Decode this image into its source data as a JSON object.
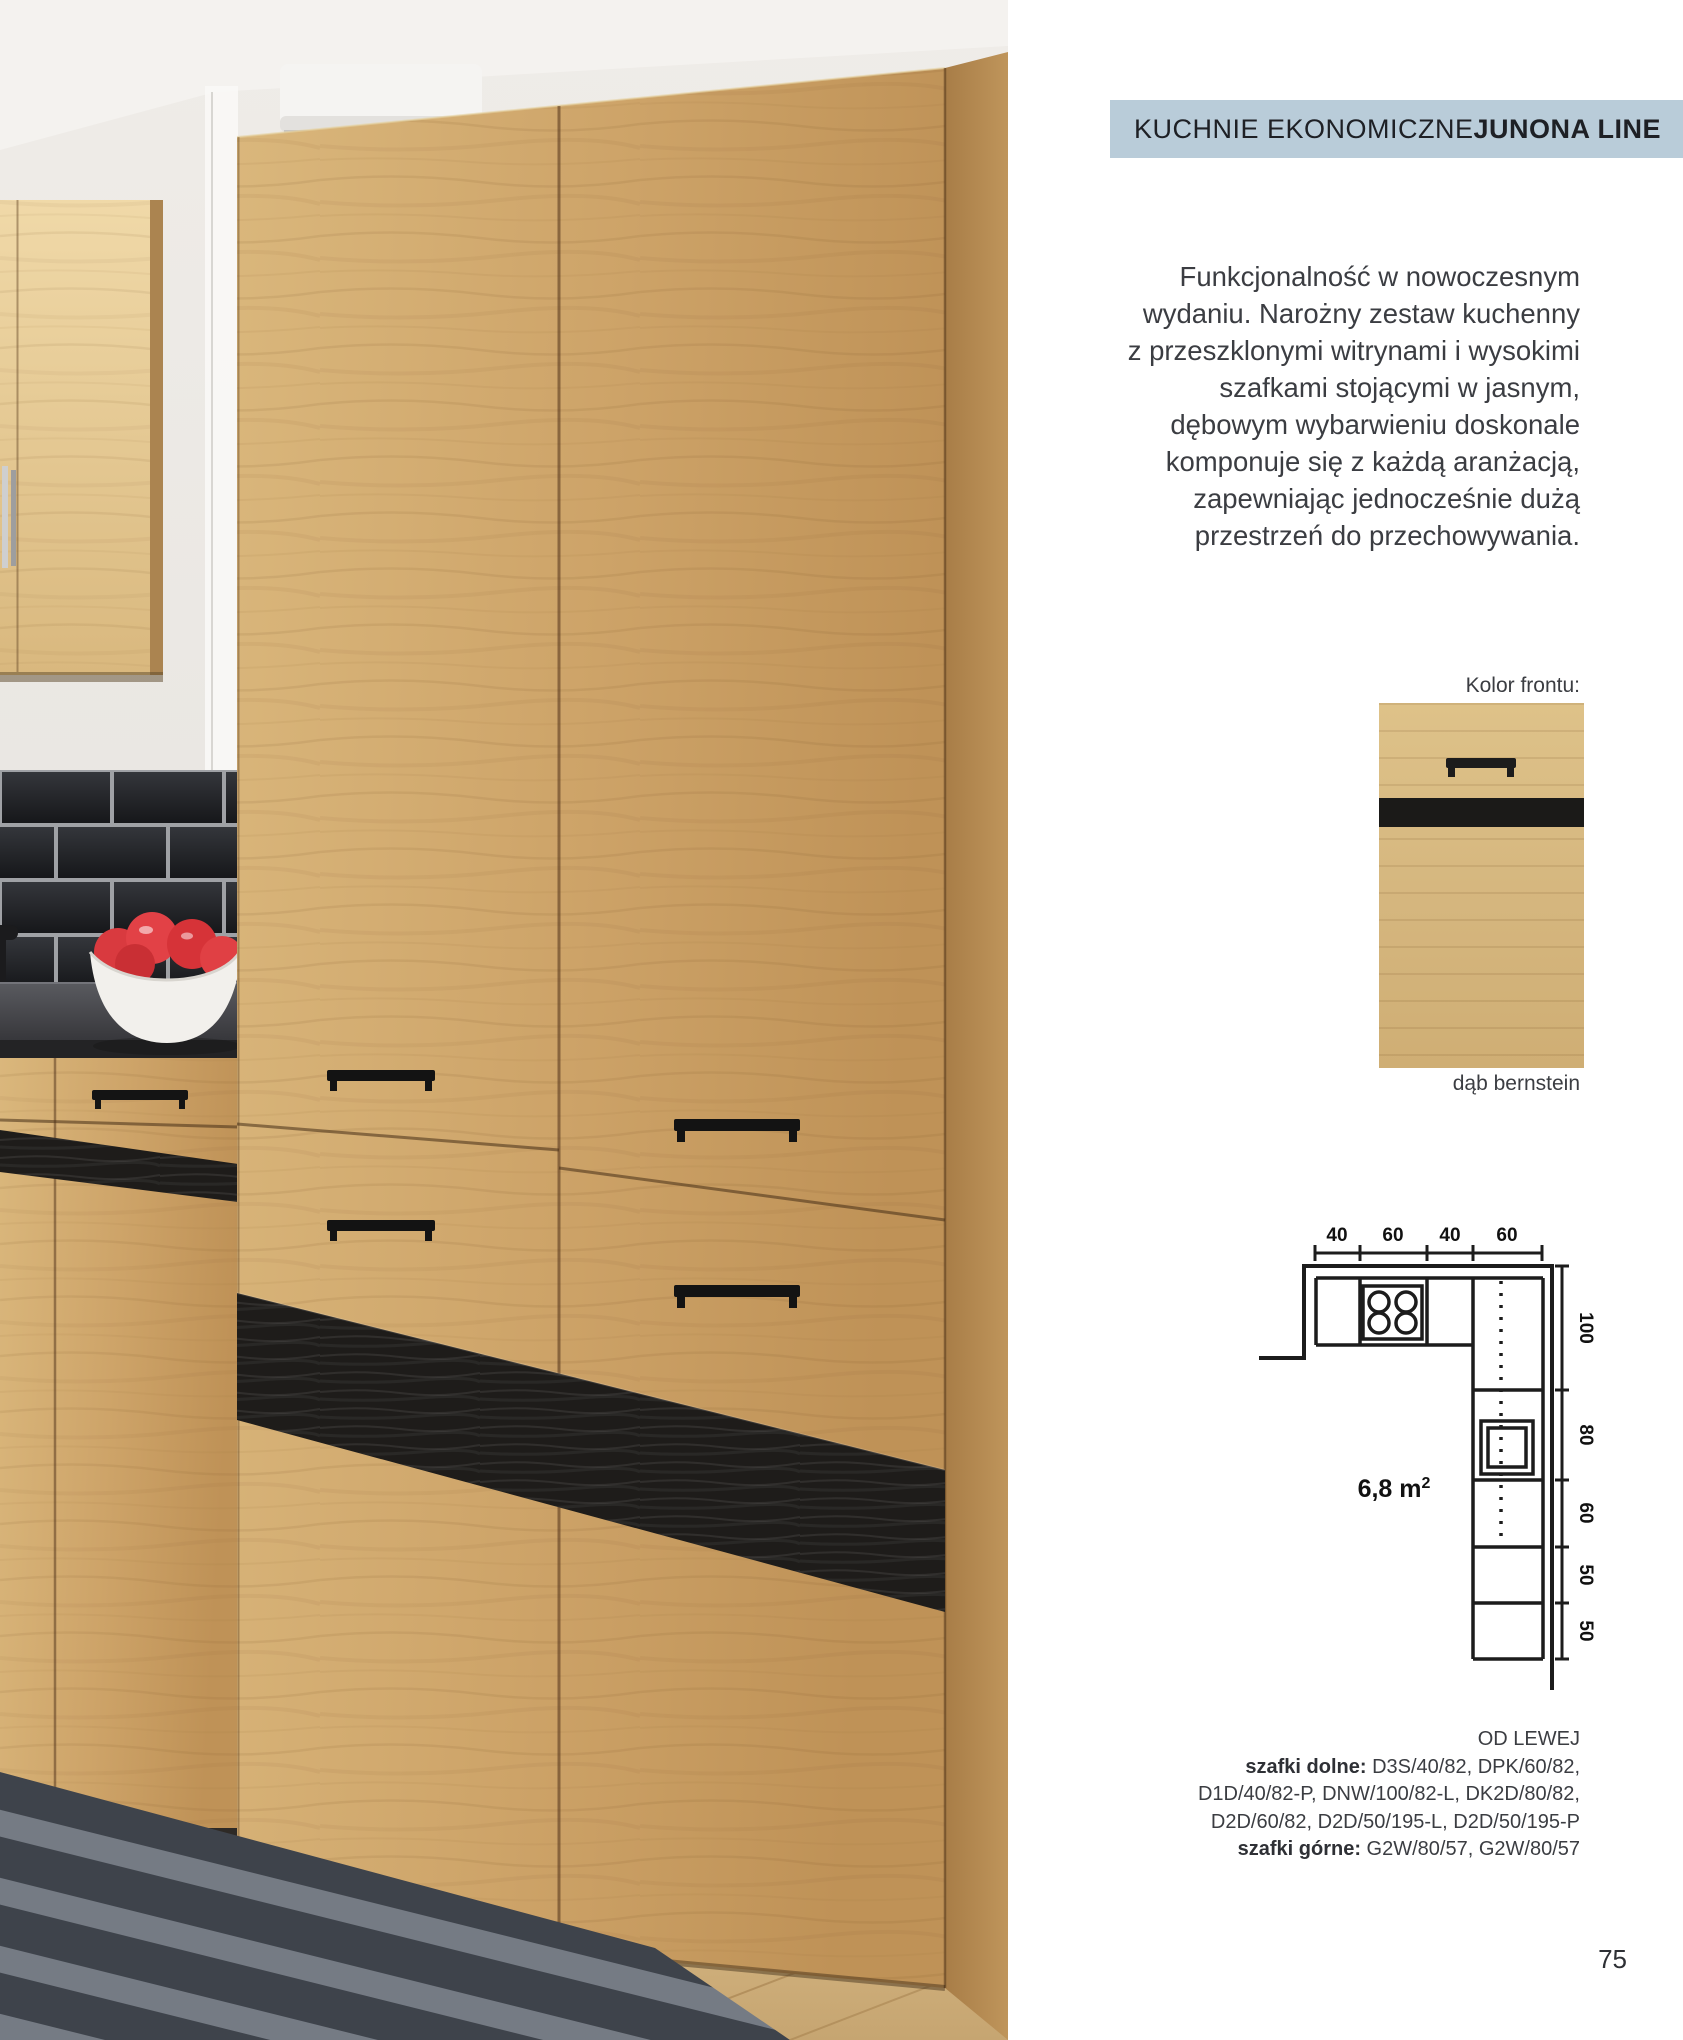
{
  "page": {
    "number": "75"
  },
  "header": {
    "category": "KUCHNIE EKONOMICZNE ",
    "collection": "JUNONA LINE",
    "badge_bg": "#b9ccd9"
  },
  "description": {
    "lines": [
      "Funkcjonalność w nowoczesnym",
      "wydaniu. Narożny zestaw kuchenny",
      "z przeszklonymi witrynami i wysokimi",
      "szafkami stojącymi w jasnym,",
      "dębowym wybarwieniu doskonale",
      "komponuje się z każdą aranżacją,",
      "zapewniając jednocześnie dużą",
      "przestrzeń do przechowywania."
    ]
  },
  "front_color": {
    "label": "Kolor frontu:",
    "swatch_name": "dąb bernstein"
  },
  "diagram": {
    "area_value": "6,8 m",
    "area_unit_sup": "2",
    "top_dims": [
      "40",
      "60",
      "40",
      "60"
    ],
    "side_dims": [
      "100",
      "80",
      "60",
      "50",
      "50"
    ]
  },
  "cabinet_list": {
    "from_left": "OD LEWEJ",
    "bottom_label": "szafki dolne:",
    "bottom_codes": " D3S/40/82, DPK/60/82,",
    "bottom_codes_line2": "D1D/40/82-P, DNW/100/82-L, DK2D/80/82,",
    "bottom_codes_line3": "D2D/60/82, D2D/50/195-L, D2D/50/195-P",
    "top_label": "szafki górne:",
    "top_codes": " G2W/80/57, G2W/80/57"
  },
  "colors": {
    "badge_bg": "#b9ccd9",
    "body_text": "#3b3d42",
    "wood": "#cda368",
    "accent_stripe": "#1e1c1a",
    "tile": "#1d1f23",
    "counter": "#3a3a3e",
    "tomato": "#e03a3e",
    "rug": "#4a4e55"
  }
}
